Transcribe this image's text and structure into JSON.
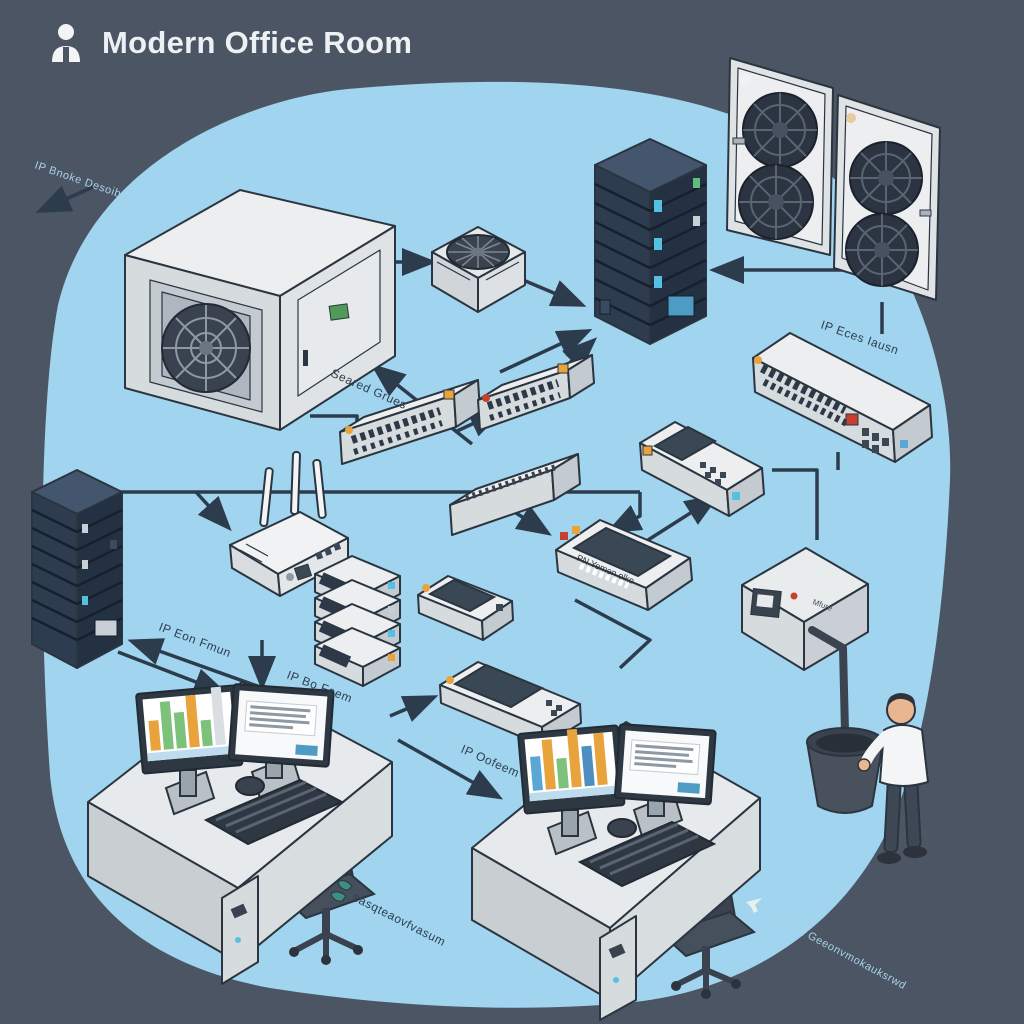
{
  "header": {
    "title": "Modern Office Room"
  },
  "labels": {
    "top_left": "IP Bnoke Desoibon",
    "cabinet_link": "Seared Grues",
    "core_switch": "IP Eces Iausn",
    "rack_link": "IP Eon Fmun",
    "desk_left_link": "IP Bo Feem",
    "desk_right_link": "IP Oofeem",
    "mixer_face": "PN Yemen olko",
    "shredder_face": "Mfure",
    "bottom_center": "sasqteaovfvasum",
    "bottom_right": "Cuirnea Geeonvmokauksrwd"
  },
  "colors": {
    "background": "#4b5563",
    "room": "#a0d4ef",
    "line": "#2c3c4d",
    "device_light": "#e9eced",
    "device_mid": "#d6dbde",
    "device_side": "#bfc6cc",
    "rack_dark": "#2e3c50",
    "accent_orange": "#e8a33d",
    "accent_green": "#7cc27a",
    "accent_blue": "#5aa7d6",
    "accent_teal": "#55c1e0",
    "accent_red": "#c6402e"
  },
  "monitors": {
    "left_chart": {
      "bars": [
        {
          "h": 30,
          "c": "#e8a33d"
        },
        {
          "h": 48,
          "c": "#7cc27a"
        },
        {
          "h": 36,
          "c": "#7cc27a"
        },
        {
          "h": 52,
          "c": "#e8a33d"
        },
        {
          "h": 26,
          "c": "#7cc27a"
        },
        {
          "h": 58,
          "c": "#d8dee2"
        }
      ]
    },
    "right_chart": {
      "bars": [
        {
          "h": 34,
          "c": "#5aa7d6"
        },
        {
          "h": 50,
          "c": "#e8a33d"
        },
        {
          "h": 30,
          "c": "#7cc27a"
        },
        {
          "h": 58,
          "c": "#e8a33d"
        },
        {
          "h": 40,
          "c": "#4e8fc0"
        },
        {
          "h": 52,
          "c": "#e8a33d"
        }
      ]
    }
  }
}
